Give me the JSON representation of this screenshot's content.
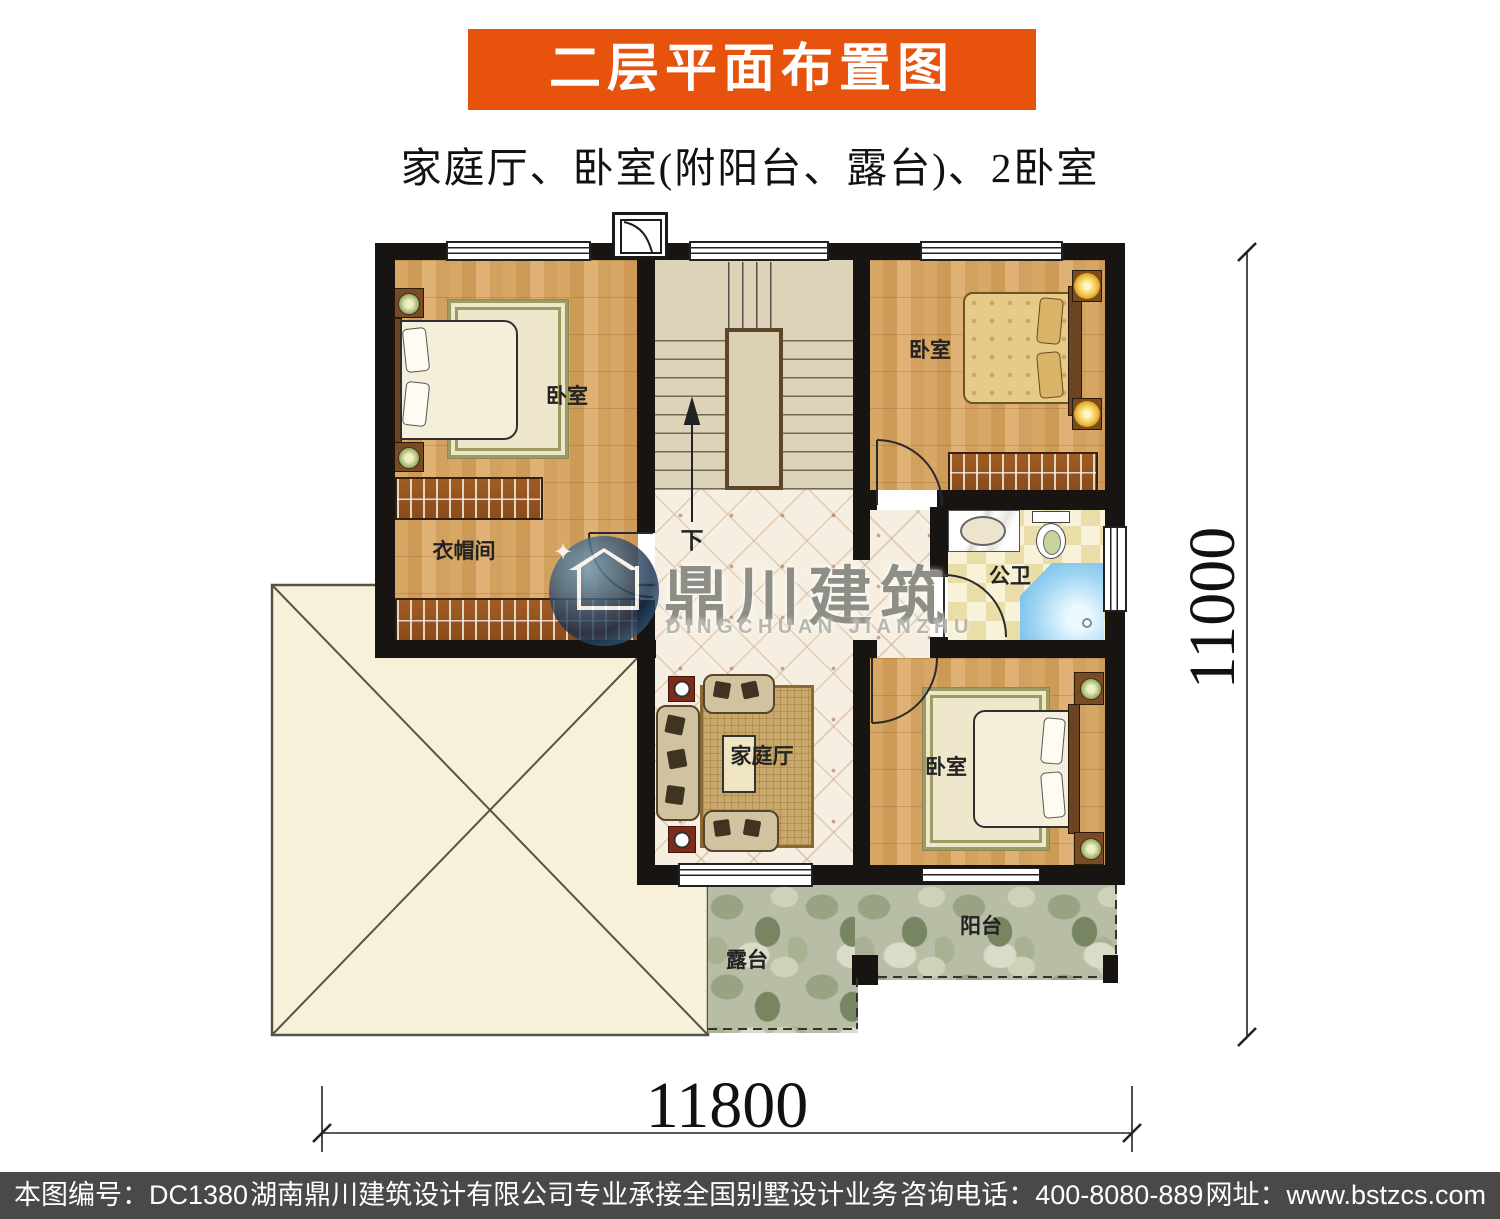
{
  "header": {
    "title": "二层平面布置图",
    "subtitle": "家庭厅、卧室(附阳台、露台)、2卧室"
  },
  "plan": {
    "rooms": {
      "bedroom_top_left": "卧室",
      "cloakroom": "衣帽间",
      "bedroom_top_right": "卧室",
      "bathroom": "公卫",
      "family_hall": "家庭厅",
      "bedroom_bottom_right": "卧室",
      "terrace": "露台",
      "balcony": "阳台",
      "stairs_down": "下"
    },
    "dimensions": {
      "width": "11800",
      "height": "11000"
    }
  },
  "watermark": {
    "cn": "鼎川建筑",
    "en": "DINGCHUAN JIANZHU"
  },
  "footer": {
    "plan_no": "本图编号：DC1380",
    "company": "湖南鼎川建筑设计有限公司专业承接全国别墅设计业务",
    "phone": "咨询电话：400-8080-889",
    "website": "网址：www.bstzcs.com"
  },
  "colors": {
    "banner_bg": "#E7530D",
    "footer_bg": "#4B4947",
    "wall": "#171412",
    "wood_floor": "#D5A263",
    "tile_floor": "#F6EFE1",
    "stone_floor": "#B8BEA6",
    "roof_fill": "#F8F1DA",
    "shower_blue": "#5FB2E6"
  }
}
